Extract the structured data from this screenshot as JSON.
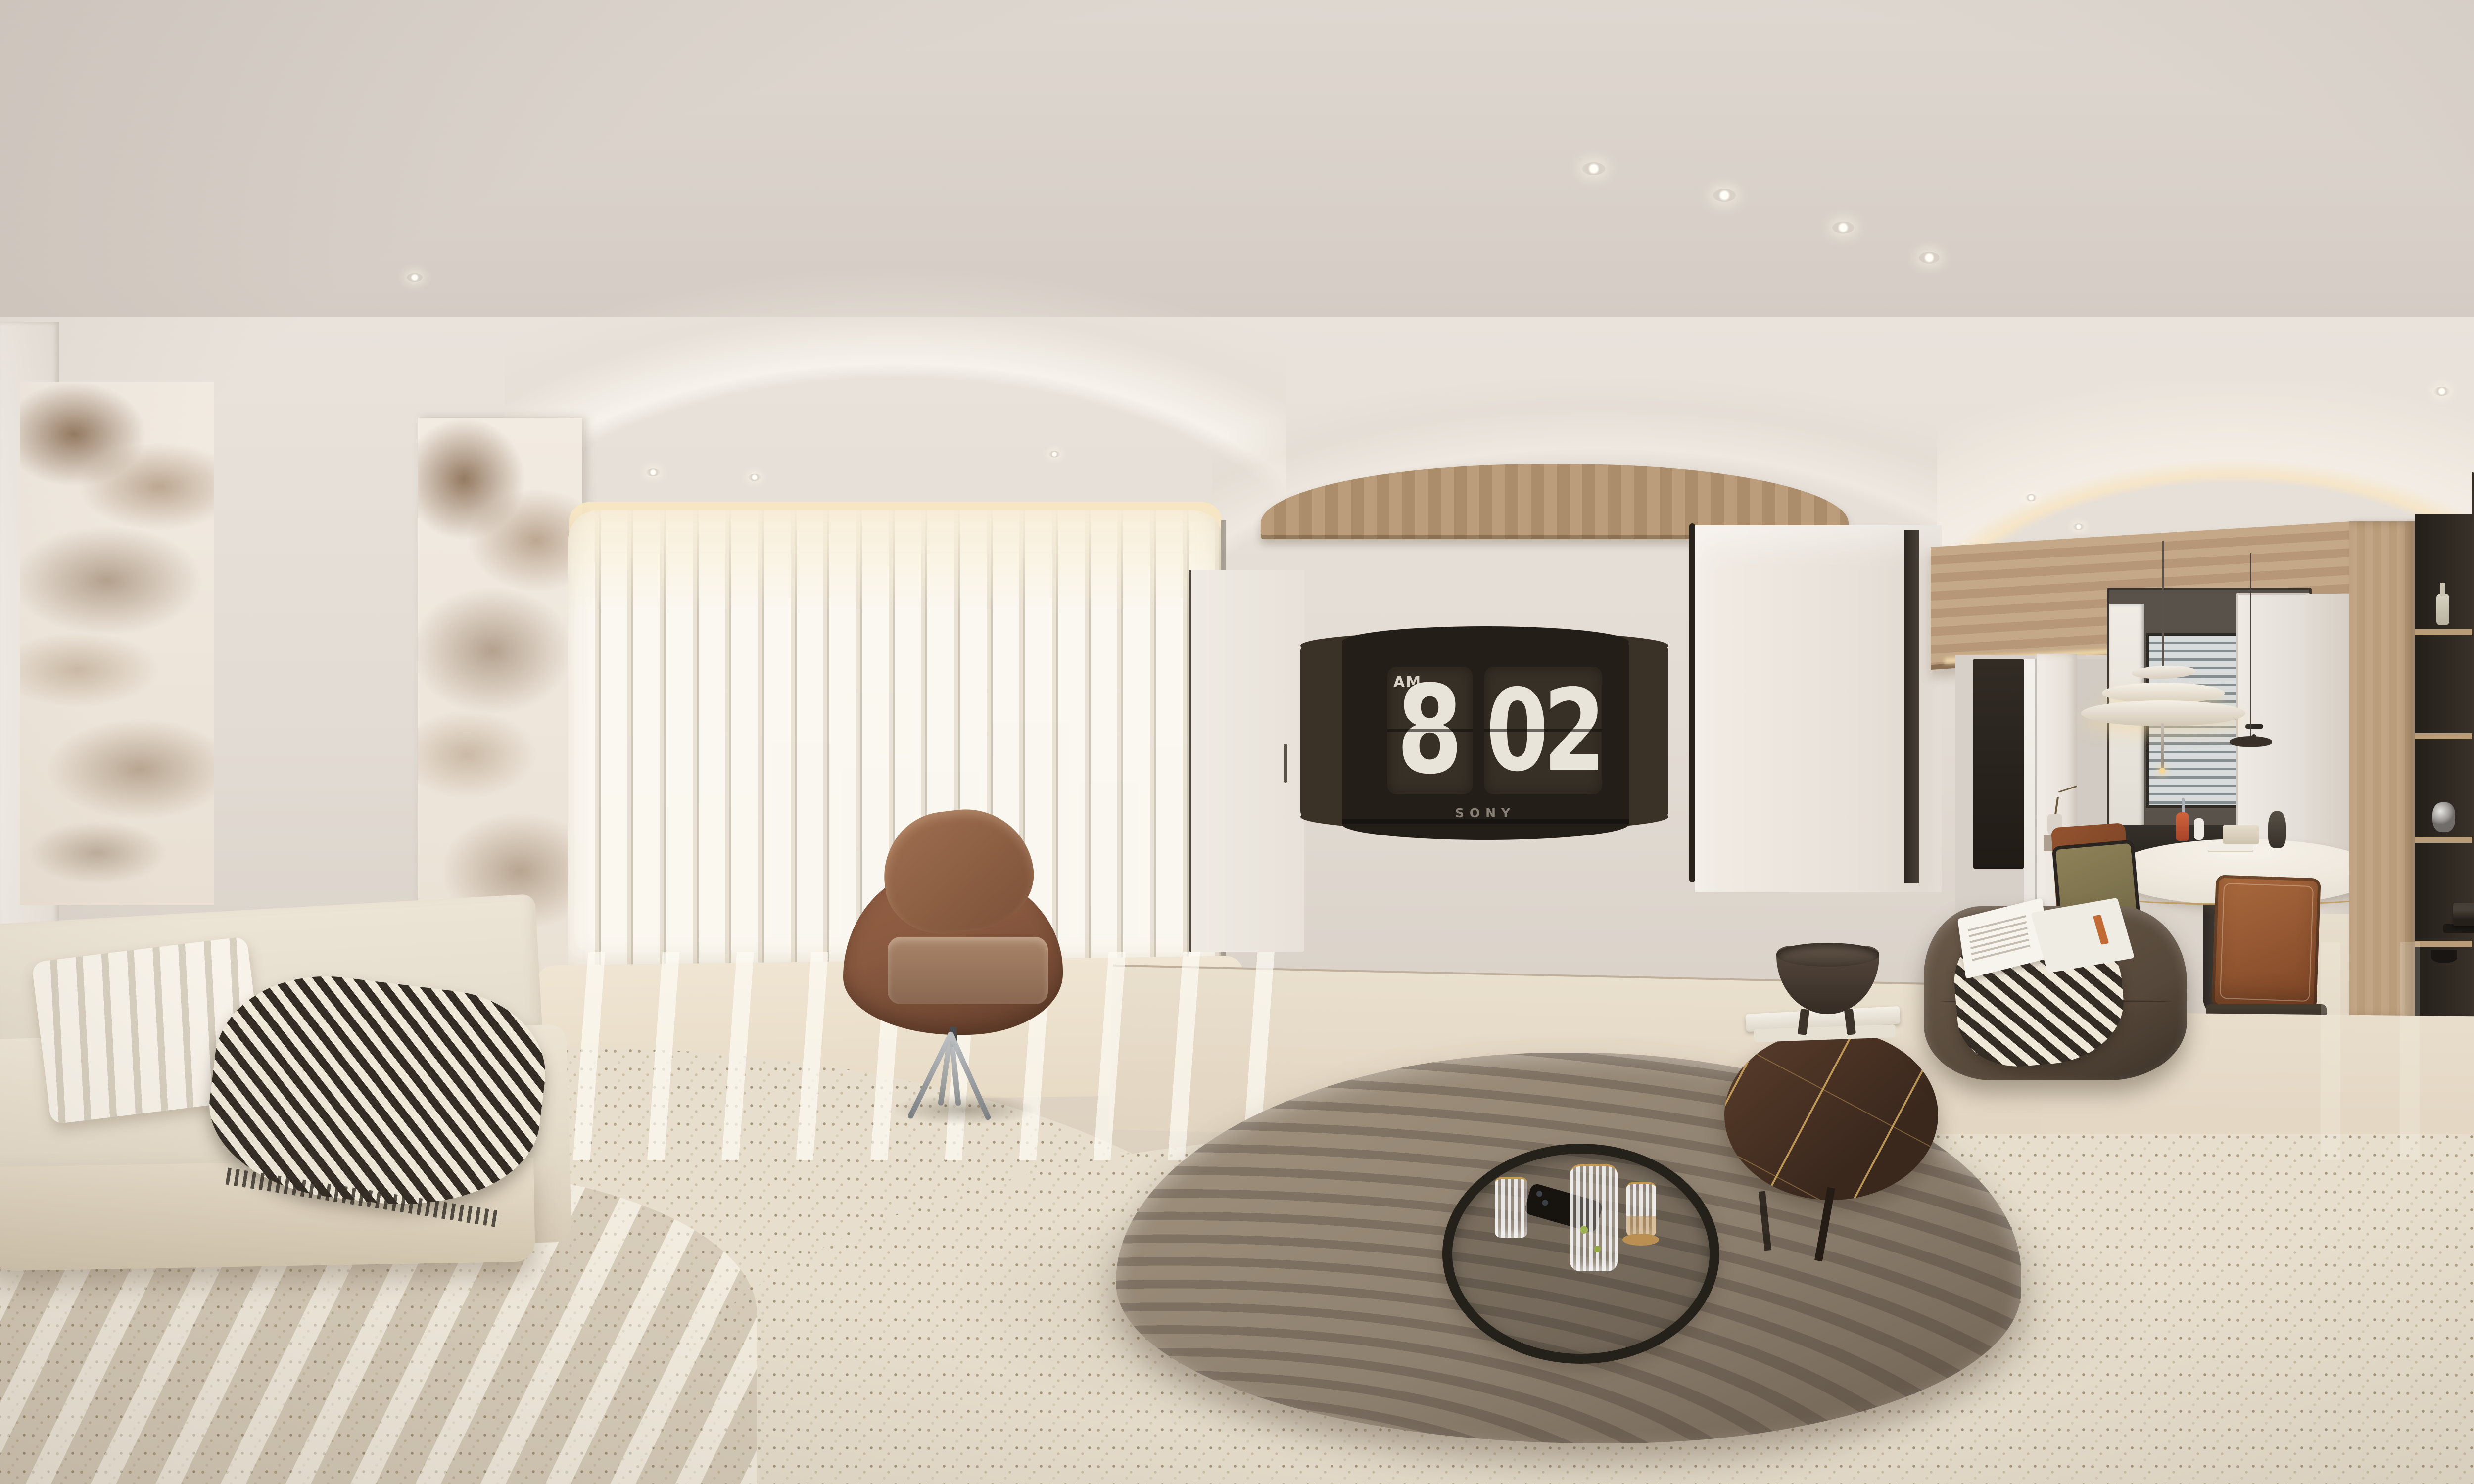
{
  "scene": {
    "type": "equirectangular 360-degree interior panorama render",
    "room": "minimalist cream living and dining room with warm wood and dark accents"
  },
  "tv": {
    "brand": "SONY",
    "clock_meridiem": "AM",
    "clock_hour": "8",
    "clock_minute": "02"
  },
  "palette": {
    "ceiling": "#d6cec6",
    "wall": "#e7e0d8",
    "floor": "#ddd2c0",
    "rug": "#e7decd",
    "wood_oak_light": "#c2a585",
    "wood_beam": "#bb9d7c",
    "wood_wenge": "#3f352a",
    "tv_screen": "#241e18",
    "tv_side_panel": "#3a3127",
    "clock_card": "#373027",
    "clock_digit": "#e9e4d9",
    "leather_armchair": "#8a5a40",
    "leather_ottoman": "#56483a",
    "leather_dining_chair": "#9b5c35",
    "sofa_cream": "#ece4d5",
    "pillow_brown": "#7a5743",
    "coffee_table_taupe": "#8f8170",
    "marble_vein_brown": "#8a6a4f",
    "figurine_blue": "#8fb3d6",
    "pendant_glow": "#f2dcae",
    "dark_trim": "#29231c"
  },
  "objects": {
    "left_wall": "two bookmatched brown-veined marble feature panels",
    "window": "floor-to-ceiling vertical sheer blinds with city skyline",
    "armchair": "cognac leather swivel lounge chair on metal star base",
    "tv": "wall-mounted Sony TV showing flip-clock screensaver",
    "coffee_table": "organic taupe coffee table with ripple light stripes",
    "tray": "round black tray with carafe, ribbed glasses and phone",
    "side_table": "dark gold-veined marble side table with books and wooden bowl",
    "ottoman": "tufted dark leather ottoman with houndstooth throw and open magazine",
    "sofas": "cream modular fabric sofas with ribbed, striped and brown pillows",
    "dining": "round white dining table, olive and cognac leather chairs",
    "pendant": "layered organic pendant lamp over dining table",
    "kitchen": "kitchen behind smoked glass partition with venetian blinds",
    "cabinetry": "light oak cabinet with dark display shelves, wenge wardrobe panels",
    "figurine": "blue cartoon figurine seated on books behind right sofa"
  }
}
